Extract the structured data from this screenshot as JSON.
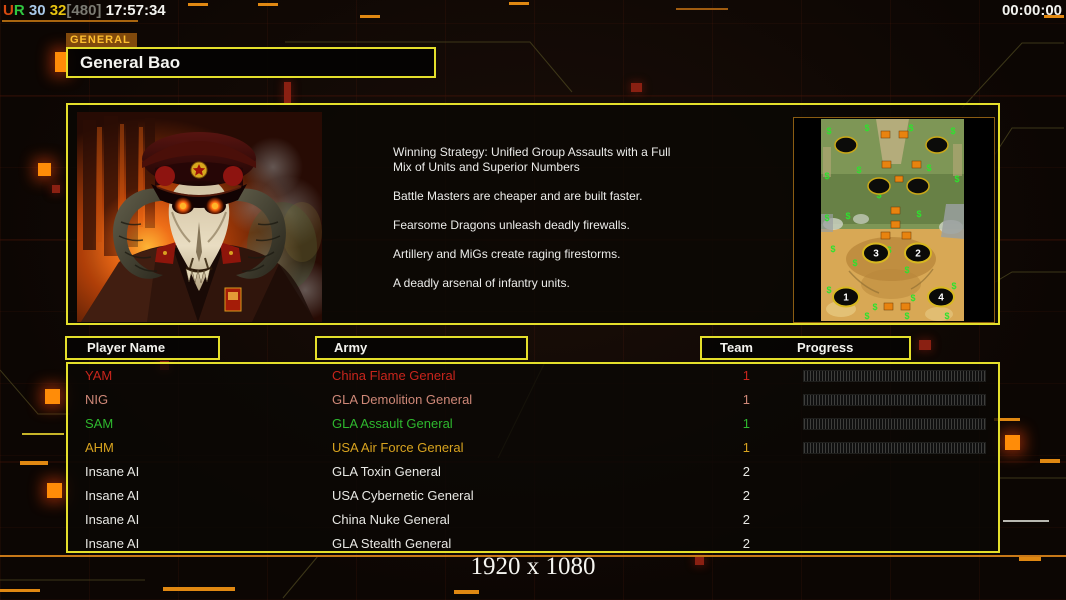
{
  "hud": {
    "stats_segments": [
      {
        "text": "U",
        "color": "#d84a10"
      },
      {
        "text": "R",
        "color": "#30c840"
      },
      {
        "text": " 30",
        "color": "#a8c8e8"
      },
      {
        "text": " 32",
        "color": "#e8c410"
      },
      {
        "text": "[480]",
        "color": "#7a7a72"
      },
      {
        "text": " 17:57:34",
        "color": "#f2f2ee"
      }
    ],
    "timer": "00:00:00"
  },
  "general": {
    "tab_label": "GENERAL",
    "name": "General Bao"
  },
  "strategy_paragraphs": [
    "Winning Strategy: Unified Group Assaults with a Full\n Mix of Units and Superior Numbers",
    "Battle Masters are cheaper and are built faster.",
    "Fearsome Dragons unleash deadly firewalls.",
    "Artillery and MiGs create raging firestorms.",
    "A deadly arsenal of infantry units."
  ],
  "minimap": {
    "numbered_start_positions": [
      "1",
      "2",
      "3",
      "4"
    ]
  },
  "table": {
    "headers": {
      "player_name": "Player Name",
      "army": "Army",
      "team": "Team",
      "progress": "Progress"
    },
    "rows": [
      {
        "player": "YAM",
        "army": "China Flame General",
        "team": "1",
        "color": "#c8251c",
        "progress": true
      },
      {
        "player": "NIG",
        "army": "GLA Demolition General",
        "team": "1",
        "color": "#cf8878",
        "progress": true
      },
      {
        "player": "SAM",
        "army": "GLA Assault General",
        "team": "1",
        "color": "#2eb82e",
        "progress": true
      },
      {
        "player": "AHM",
        "army": "USA Air Force General",
        "team": "1",
        "color": "#d8a31f",
        "progress": true
      },
      {
        "player": "Insane AI",
        "army": "GLA Toxin General",
        "team": "2",
        "color": "#e8e8e4",
        "progress": false
      },
      {
        "player": "Insane AI",
        "army": "USA Cybernetic General",
        "team": "2",
        "color": "#e8e8e4",
        "progress": false
      },
      {
        "player": "Insane AI",
        "army": "China Nuke General",
        "team": "2",
        "color": "#e8e8e4",
        "progress": false
      },
      {
        "player": "Insane AI",
        "army": "GLA Stealth General",
        "team": "2",
        "color": "#e8e8e4",
        "progress": false
      }
    ]
  },
  "footer": {
    "resolution_label": "1920 x 1080"
  },
  "colors": {
    "accent_yellow": "#e4df2b",
    "accent_orange": "#e8820f",
    "player_red": "#c8251c",
    "player_pink": "#cf8878",
    "player_green": "#2eb82e",
    "player_gold": "#d8a31f",
    "ai_white": "#e8e8e4"
  }
}
